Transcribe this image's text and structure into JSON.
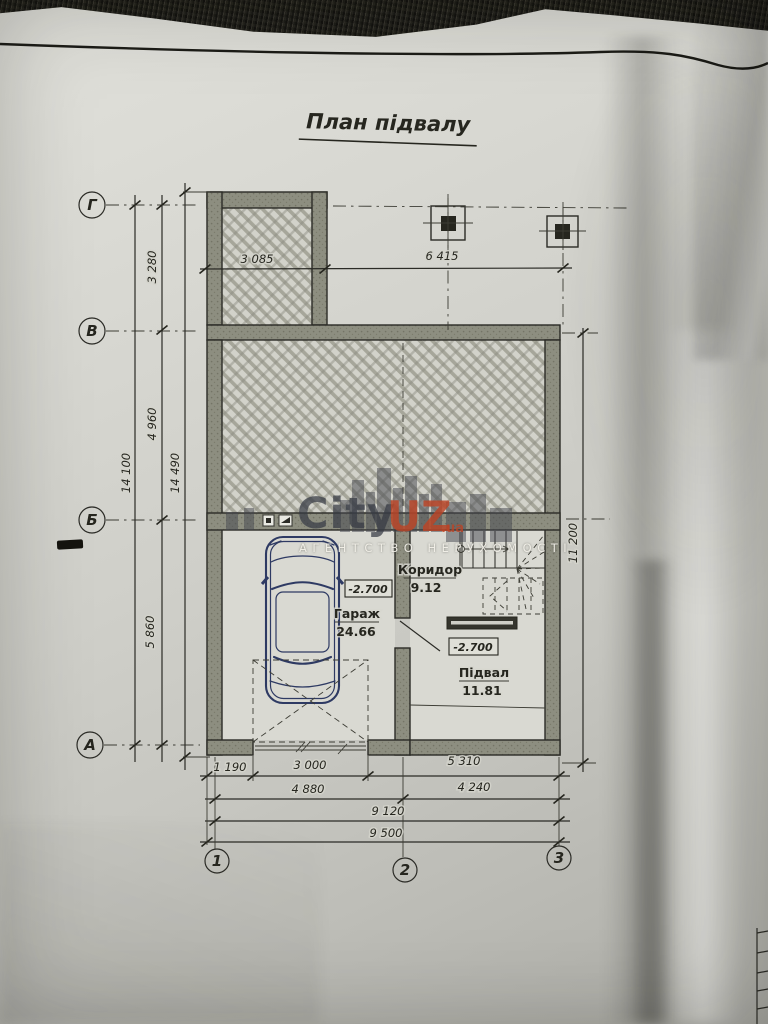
{
  "title": "План підвалу",
  "axis": {
    "r1": "Г",
    "r2": "В",
    "r3": "Б",
    "r4": "А",
    "c1": "1",
    "c2": "2",
    "c3": "3"
  },
  "dims": {
    "top_left": "3 085",
    "top_right": "6 415",
    "left_seg1": "3 280",
    "left_seg2": "4 960",
    "left_seg3": "5 860",
    "left_total_axes": "14 100",
    "left_total_walls": "14 490",
    "right_total": "11 200",
    "b1_1": "1 190",
    "b1_2": "3 000",
    "b1_3": "5 310",
    "b2_1": "4 880",
    "b2_2": "4 240",
    "b3_total": "9 120",
    "b4_total": "9 500"
  },
  "rooms": {
    "garage": {
      "name": "Гараж",
      "area": "24.66",
      "elev": "-2.700"
    },
    "corridor": {
      "name": "Коридор",
      "area": "9.12"
    },
    "basement": {
      "name": "Підвал",
      "area": "11.81",
      "elev": "-2.700"
    }
  },
  "watermark": {
    "city": "City",
    "uz": "UZ",
    "domain": ".ua",
    "tagline": "АГЕНТСТВО НЕРУХОМОСТІ"
  },
  "colors": {
    "ink": "#2b2b26",
    "wall": "#8e8e80",
    "car": "#2e3a63",
    "brand_orange": "#bc4426"
  }
}
